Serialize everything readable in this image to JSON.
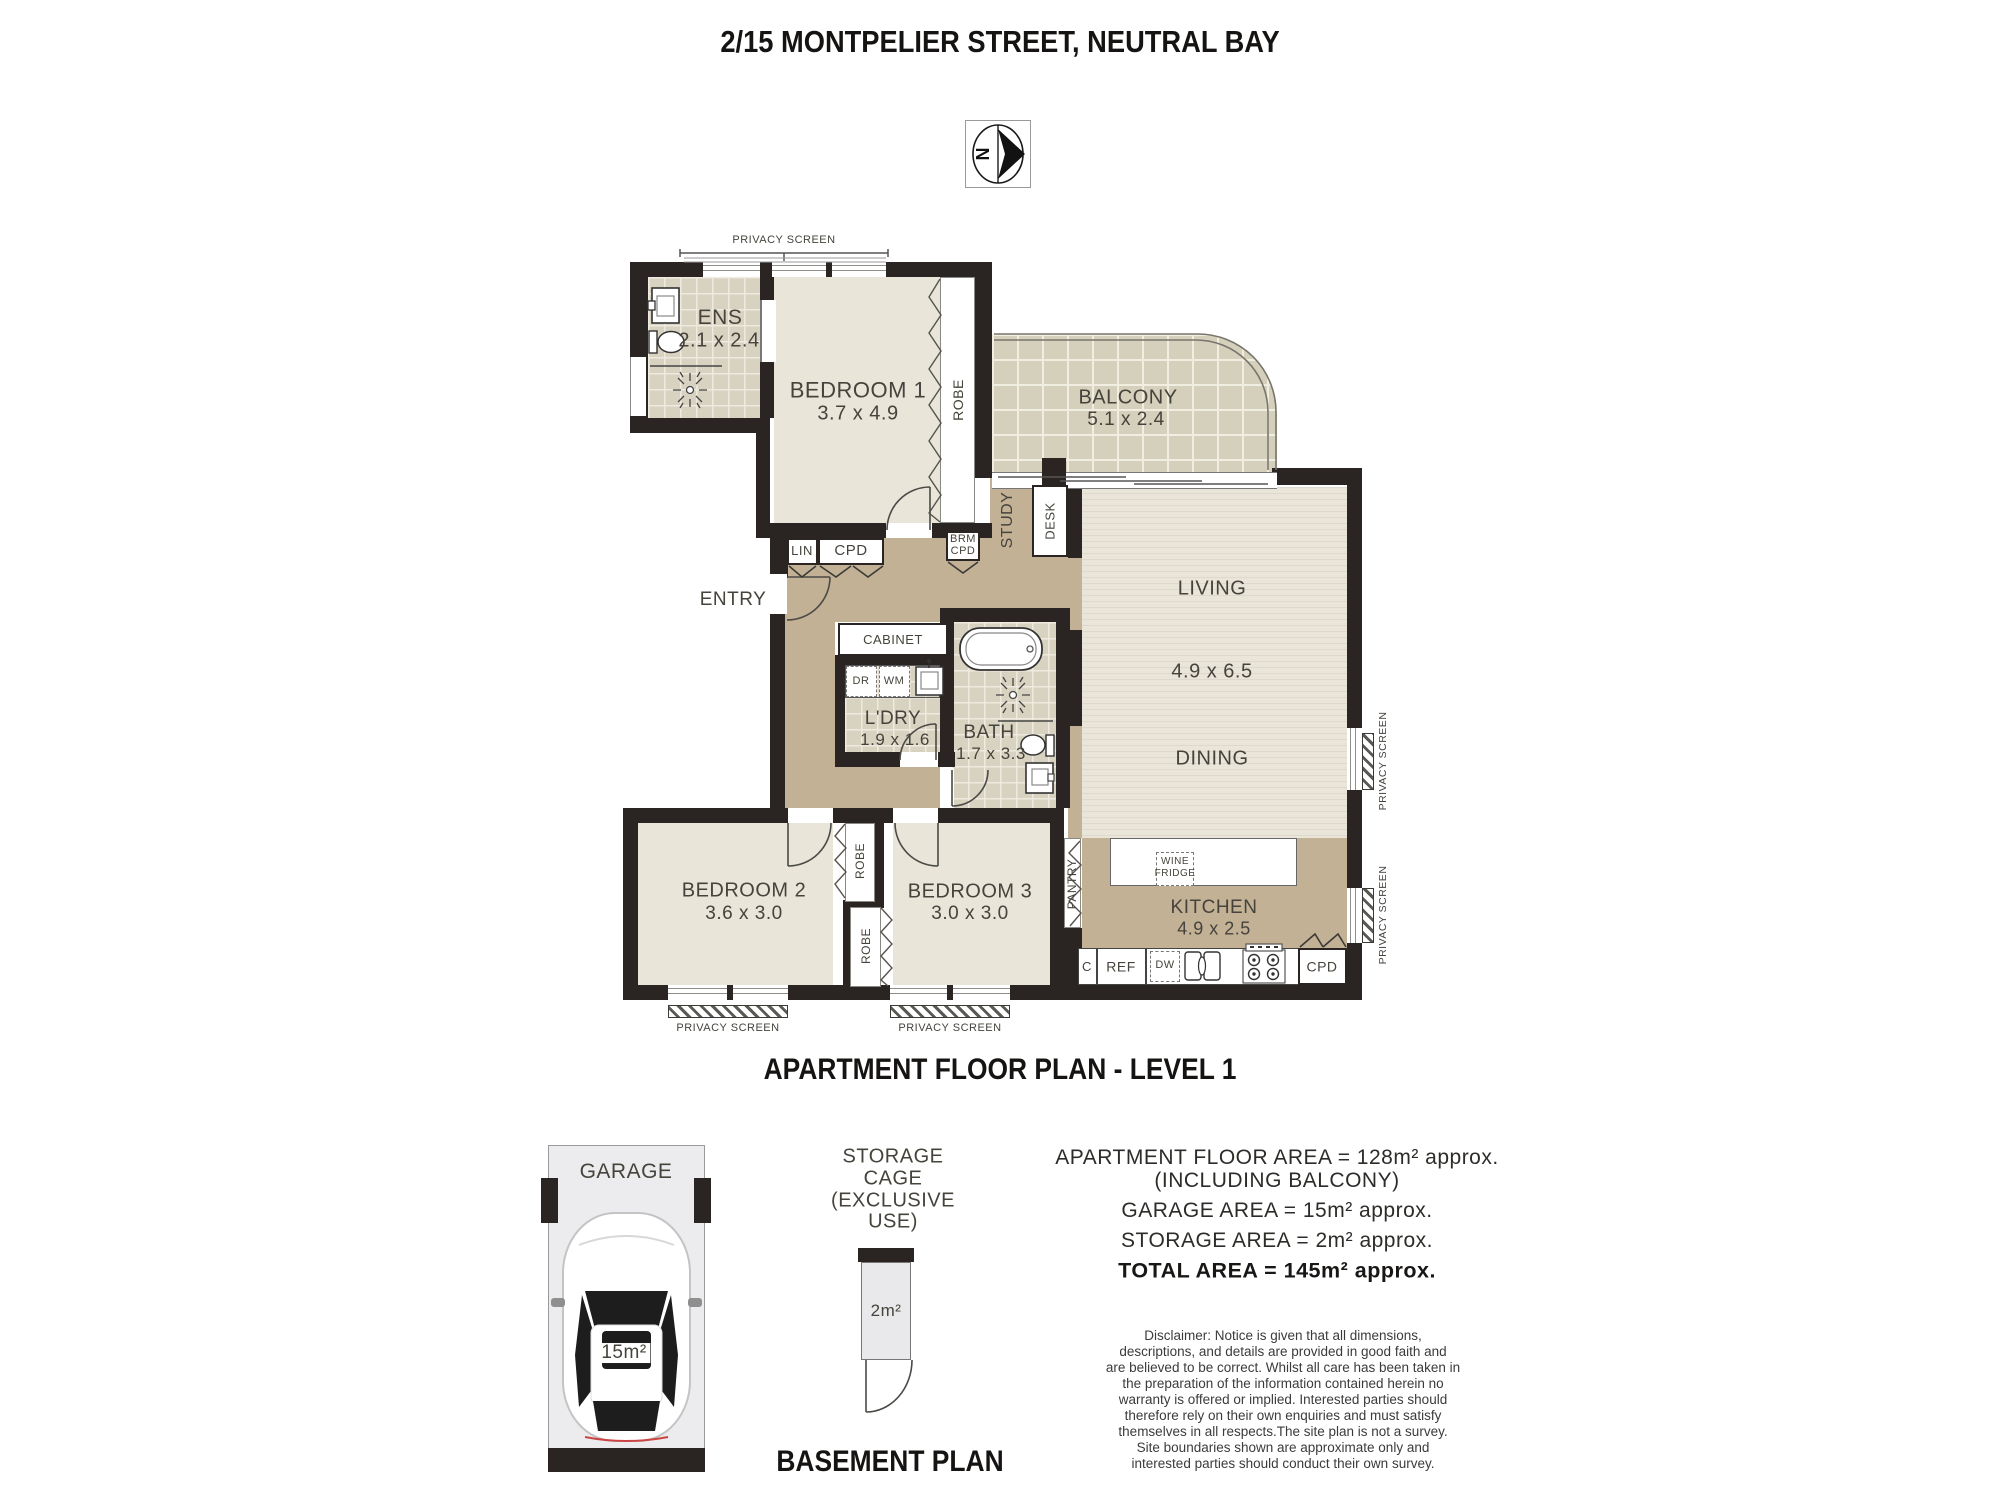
{
  "header": {
    "title": "2/15 MONTPELIER STREET, NEUTRAL BAY",
    "compass_letter": "N"
  },
  "level1": {
    "heading": "APARTMENT FLOOR PLAN - LEVEL 1",
    "rooms": {
      "ens": {
        "name": "ENS",
        "dims": "2.1 x 2.4"
      },
      "bedroom1": {
        "name": "BEDROOM 1",
        "dims": "3.7 x 4.9"
      },
      "balcony": {
        "name": "BALCONY",
        "dims": "5.1 x 2.4"
      },
      "living": {
        "name": "LIVING",
        "dims": "4.9 x 6.5"
      },
      "dining": {
        "name": "DINING"
      },
      "kitchen": {
        "name": "KITCHEN",
        "dims": "4.9 x 2.5"
      },
      "laundry": {
        "name": "L'DRY",
        "dims": "1.9 x 1.6"
      },
      "bath": {
        "name": "BATH",
        "dims": "1.7 x 3.3"
      },
      "bedroom2": {
        "name": "BEDROOM 2",
        "dims": "3.6 x 3.0"
      },
      "bedroom3": {
        "name": "BEDROOM 3",
        "dims": "3.0 x 3.0"
      },
      "study": {
        "name": "STUDY"
      },
      "entry": {
        "name": "ENTRY"
      }
    },
    "features": {
      "robe": "ROBE",
      "lin": "LIN",
      "cpd": "CPD",
      "brm_line1": "BRM",
      "brm_line2": "CPD",
      "desk": "DESK",
      "cabinet": "CABINET",
      "dr": "DR",
      "wm": "WM",
      "pantry": "PANTRY",
      "wine_line1": "WINE",
      "wine_line2": "FRIDGE",
      "c": "C",
      "ref": "REF",
      "dw": "DW",
      "cpd_kitchen": "CPD",
      "privacy": "PRIVACY SCREEN"
    }
  },
  "basement": {
    "heading": "BASEMENT PLAN",
    "garage": {
      "label": "GARAGE",
      "area": "15m²"
    },
    "storage": {
      "line1": "STORAGE",
      "line2": "CAGE",
      "line3": "(EXCLUSIVE",
      "line4": "USE)",
      "area": "2m²"
    }
  },
  "areas": {
    "lines": [
      "APARTMENT FLOOR AREA = 128m² approx.",
      "(INCLUDING BALCONY)",
      "GARAGE  AREA = 15m²  approx.",
      "STORAGE  AREA = 2m²  approx.",
      "TOTAL AREA = 145m²  approx."
    ]
  },
  "disclaimer": {
    "lines": [
      "Disclaimer: Notice is given that all dimensions,",
      "descriptions, and details are provided in good faith and",
      "are believed to be correct. Whilst all care has been taken in",
      "the preparation of the information contained herein no",
      "warranty is offered or implied. Interested parties should",
      "therefore rely on their own enquiries and must satisfy",
      "themselves in all respects.The site plan is not a survey.",
      "Site boundaries shown are approximate only and",
      "interested parties should conduct their own survey."
    ]
  }
}
